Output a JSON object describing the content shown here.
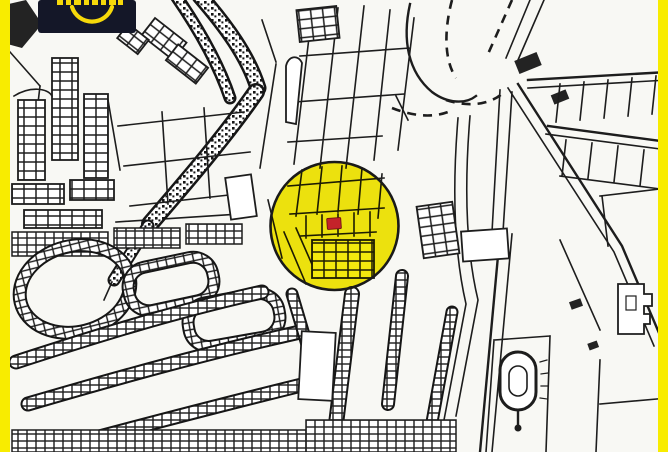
{
  "view": {
    "type": "cadastral-parcel-map",
    "background": "#f8f8f4",
    "line_color": "#1d1d1d",
    "side_border_color": "#f8ec00"
  },
  "branding": {
    "logo_bg_color": "#141728",
    "logo_accent_color": "#f6d90a",
    "smile_icon": "smile-arc",
    "wordmark_state": "cropped-at-top-edge"
  },
  "highlight": {
    "shape": "circle",
    "circle_fill": "#f3e80e",
    "circle_outline": "#1a1a1a",
    "marker_shape": "rect",
    "marker_fill": "#c4232a",
    "marker_outline": "#6e1212"
  }
}
